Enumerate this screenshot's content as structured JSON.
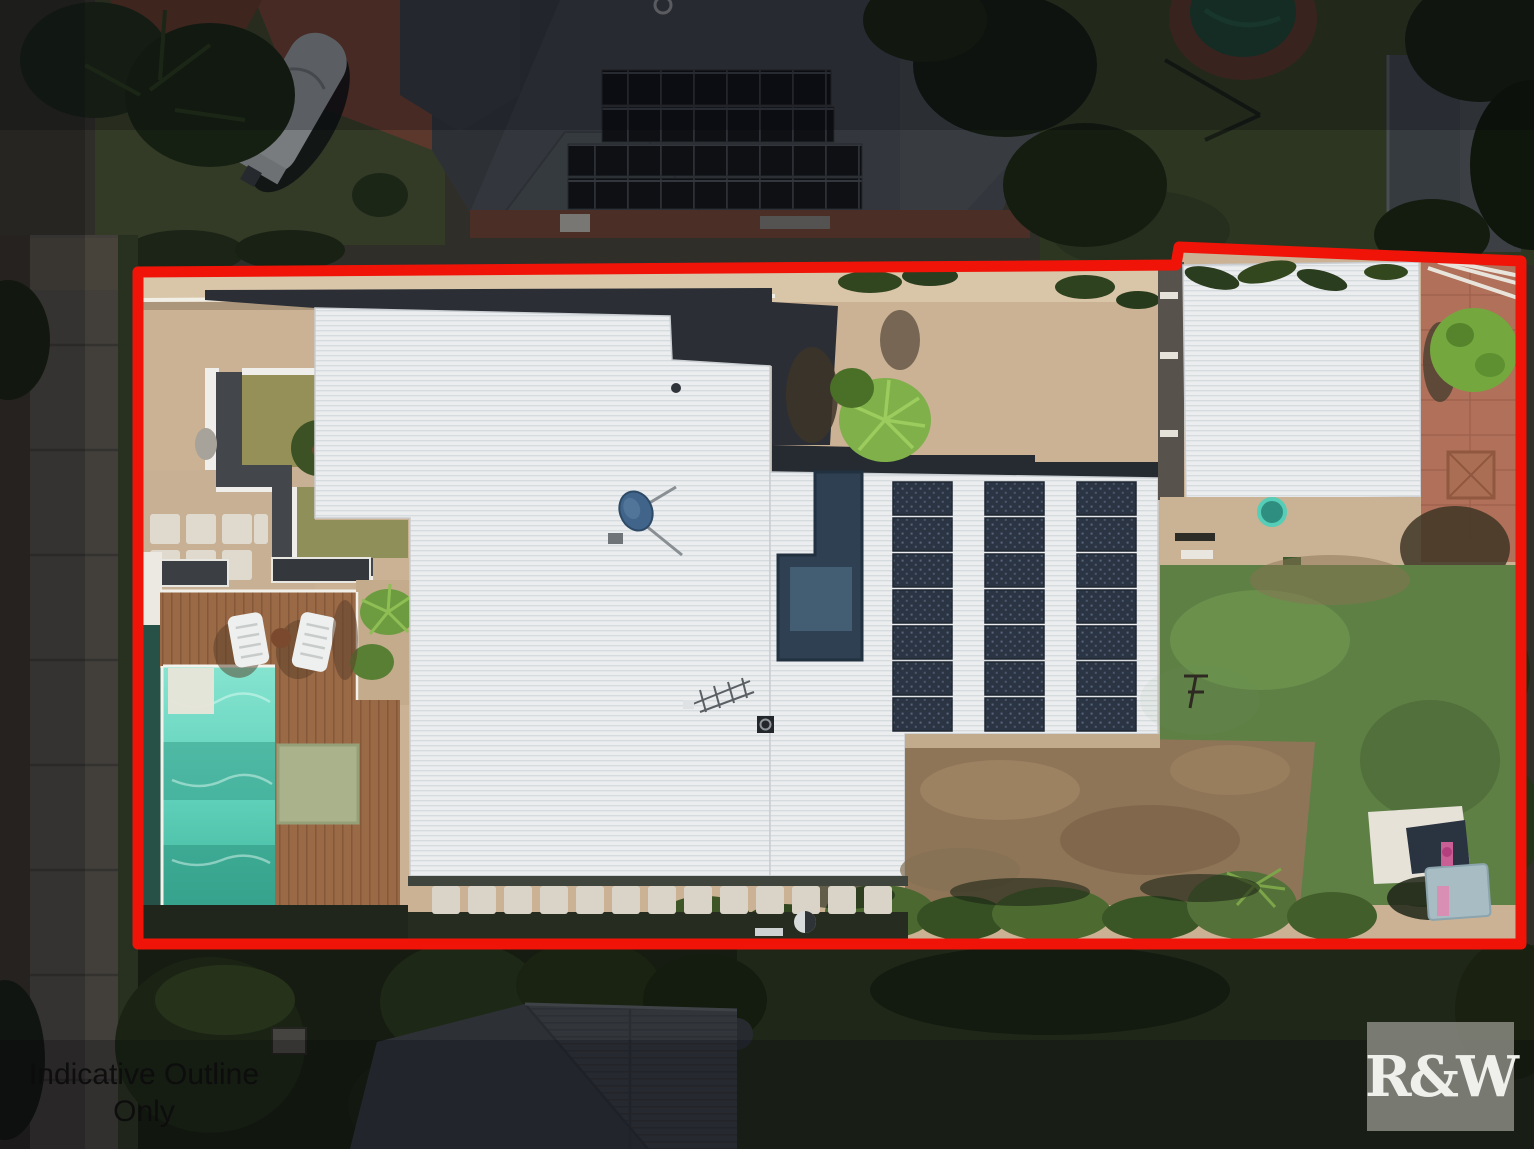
{
  "overlay": {
    "disclaimer": {
      "line1": "Indicative Outline",
      "line2": "Only"
    },
    "watermark": "R&W"
  },
  "colors": {
    "outline_red": "#f01408",
    "pool_water": "#5fd0b9",
    "roof_white": "#ebedef",
    "deck_brown": "#9a6a47",
    "solar_panel": "#2b3442",
    "watermark_text": "#efefec"
  }
}
